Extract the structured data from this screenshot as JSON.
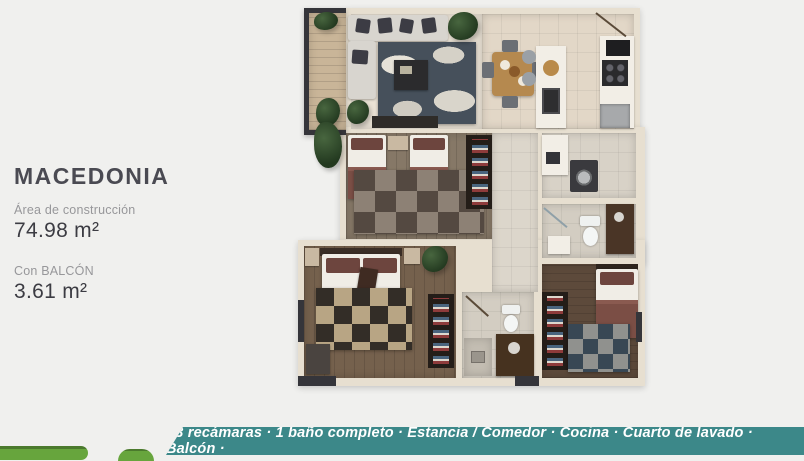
{
  "info": {
    "title": "MACEDONIA",
    "construction_label": "Área de construcción",
    "construction_value": "74.98 m²",
    "balcony_label": "Con BALCÓN",
    "balcony_value": "3.61 m²"
  },
  "banner": {
    "features": "· 3 recámaras · 1 baño completo · Estancia / Comedor · Cocina · Cuarto de lavado · Balcón ·"
  },
  "colors": {
    "page_background": "#f0f0ee",
    "title_text": "#4a4a52",
    "label_text": "#97979a",
    "value_text": "#3c3c43",
    "banner_background": "#3c8889",
    "banner_text": "#ffffff",
    "brand_green": "#67a53d",
    "brand_green_dark": "#4b7a2d",
    "plan_wall": "#e7dfd0"
  }
}
